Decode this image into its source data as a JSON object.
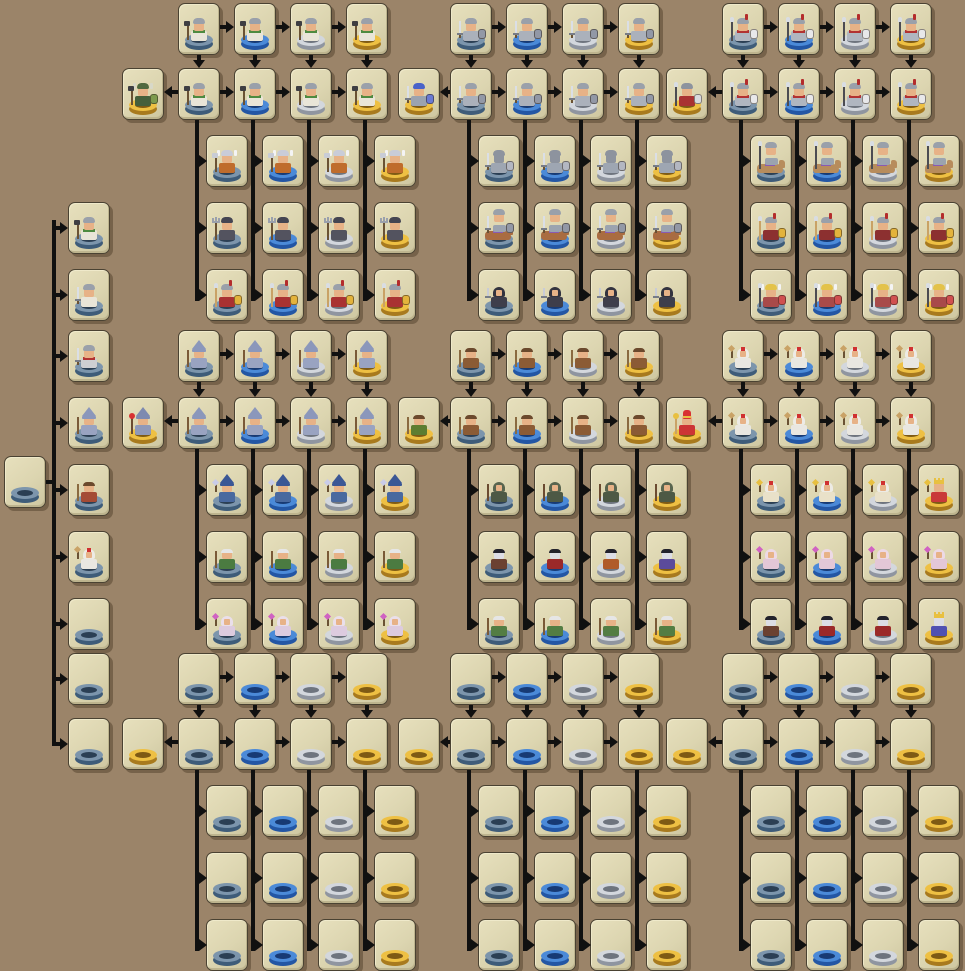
{
  "app": {
    "name": "Unit Evolution Tree",
    "description": "Pixel-art unit upgrade tree with tiered bases"
  },
  "palette": {
    "background": "#9b8469",
    "card_bg": "#dcd5b0",
    "card_border": "#4a4232",
    "arrow": "#101010",
    "skin": "#e7b287",
    "pale_skin": "#dcdde5",
    "wood": "#6a5234",
    "steel": "#777c86",
    "spear_tip": "#d9dde3",
    "tiers": {
      "1": {
        "name": "slate-blue",
        "top": "#7c95ac",
        "side": "#3e5c79",
        "hole": "#2b3f54"
      },
      "2": {
        "name": "bright-blue",
        "top": "#4b8ad8",
        "side": "#2356a4",
        "hole": "#173a74"
      },
      "3": {
        "name": "silver",
        "top": "#d3d7dd",
        "side": "#8f95a0",
        "hole": "#6e747e"
      },
      "4": {
        "name": "gold",
        "top": "#eec043",
        "side": "#a87a1e",
        "hole": "#7e5a14"
      }
    }
  },
  "unit_types": {
    "viking": {
      "hat": [
        "helm",
        "#9aa0aa"
      ],
      "body": "#e9e5d8",
      "collar": "#4e8a40",
      "weapon": [
        "axe",
        "#3e3e42"
      ]
    },
    "militia_sword": {
      "hat": [
        "helm",
        "#9aa0aa"
      ],
      "body": "#e9e5d8",
      "weapon": [
        "sword",
        "#dbdfe6"
      ]
    },
    "soldier": {
      "hat": [
        "helm",
        "#9aa0aa"
      ],
      "body": "#cfcfd2",
      "collar": "#b23232",
      "weapon": [
        "sword",
        "#dbdfe6"
      ]
    },
    "viking_chief": {
      "hat": [
        "horn",
        "#50693f",
        "#d8d8c8"
      ],
      "body": "#455f3b",
      "weapon": [
        "axe",
        "#3e3e42"
      ],
      "shield": "#7d9a4d"
    },
    "winged_viking": {
      "hat": [
        "wing",
        "#c9ccd8",
        "#f4f4f4"
      ],
      "body": "#bf6c2c",
      "weapon": [
        "axe",
        "#c8ccd6"
      ]
    },
    "dark_trident": {
      "hat": [
        "helm",
        "#454552"
      ],
      "body": "#53535f",
      "weapon": [
        "trident",
        "#9aa0ac"
      ]
    },
    "spartan": {
      "hat": [
        "plume",
        "#9aa0aa",
        "#b42c2c"
      ],
      "body": "#a93232",
      "weapon": [
        "spear",
        "#c9a266"
      ],
      "shield": "#e3b33c"
    },
    "swordsman": {
      "hat": [
        "helm",
        "#9aa0aa"
      ],
      "body": "#abb1bb",
      "weapon": [
        "sword",
        "#dbdfe6"
      ],
      "shield": "#9298a6"
    },
    "blue_knight": {
      "hat": [
        "helm",
        "#4a63c9"
      ],
      "body": "#9ba3af",
      "weapon": [
        "sword",
        "#dbdfe6"
      ],
      "shield": "#6a7ad2"
    },
    "plate_knight": {
      "hat": [
        "helm",
        "#8d939e"
      ],
      "skin": "#8d939e",
      "body": "#9ea6b2",
      "weapon": [
        "sword",
        "#dbdfe6"
      ],
      "shield": "#b3b7c2"
    },
    "cavalry": {
      "mount": "#a96c41",
      "saddle": "#8a5ab2",
      "hat": [
        "helm",
        "#9aa0aa"
      ],
      "body": "#9ba3af",
      "weapon": [
        "sword",
        "#dbdfe6"
      ],
      "shield": "#9298a6"
    },
    "rogue": {
      "hat": [
        "hood",
        "#33333f"
      ],
      "body": "#3e3e4b",
      "weapon": [
        "dagger",
        "#c9ccd6"
      ]
    },
    "spearman": {
      "hat": [
        "plume",
        "#9aa0aa",
        "#b42c2c"
      ],
      "body": "#b0b6c0",
      "collar": "#b23232",
      "weapon": [
        "spear",
        "#4c4c52"
      ],
      "shield": "#e8e8ea"
    },
    "spear_champion": {
      "hat": [
        "helm",
        "#8d939e"
      ],
      "body": "#a93232",
      "weapon": [
        "spear",
        "#4c4c52"
      ],
      "shield": "#d9dade"
    },
    "lancer": {
      "mount": "#b78c5c",
      "saddle": "#8a5ab2",
      "hat": [
        "helm",
        "#9aa0aa"
      ],
      "body": "#9ba3af",
      "weapon": [
        "spear",
        "#4c4c52"
      ]
    },
    "hoplite": {
      "hat": [
        "plume",
        "#9aa0aa",
        "#b42c2c"
      ],
      "body": "#8c3030",
      "weapon": [
        "spear",
        "#c9a266"
      ],
      "shield": "#e3b33c"
    },
    "valkyrie": {
      "hat": [
        "wing",
        "#e3c24a",
        "#f4f4f4"
      ],
      "body": "#a84a4a",
      "weapon": [
        "spear",
        "#4c4c52"
      ],
      "shield": "#d05050"
    },
    "wizard": {
      "hat": [
        "point",
        "#8b97bb"
      ],
      "body": "#99a3c1",
      "weapon": [
        "staff",
        "#7a5a38"
      ]
    },
    "archmage": {
      "hat": [
        "point",
        "#7e8ab0"
      ],
      "body": "#8f99b9",
      "weapon": [
        "staff",
        "#6b4b31",
        "#d83232"
      ]
    },
    "witch": {
      "hat": [
        "point",
        "#3b5795"
      ],
      "body": "#49699f",
      "weapon": [
        "wand",
        "#c9cce8"
      ]
    },
    "green_elder": {
      "hat": [
        "hair",
        "#e6e6e6"
      ],
      "body": "#4b7b41",
      "weapon": [
        "staff",
        "#7a5a38"
      ]
    },
    "healer": {
      "hat": [
        "hood",
        "#eadfea"
      ],
      "body": "#ddcbdf",
      "weapon": [
        "wand",
        "#d062c2"
      ]
    },
    "druid": {
      "hat": [
        "hair",
        "#6b492d"
      ],
      "body": "#8b5b35",
      "weapon": [
        "staff",
        "#8a6a40"
      ]
    },
    "grove_keeper": {
      "hat": [
        "hair",
        "#6b492d"
      ],
      "body": "#5d7d31",
      "weapon": [
        "staff",
        "#8a6a40"
      ]
    },
    "ranger": {
      "hat": [
        "hood",
        "#59654f"
      ],
      "body": "#4d5945",
      "weapon": [
        "staff",
        "#6b4b31"
      ]
    },
    "elder_druid": {
      "hat": [
        "hair",
        "#e6e6e6"
      ],
      "body": "#537d43",
      "weapon": [
        "staff",
        "#7a5a38"
      ]
    },
    "cleric": {
      "hat": [
        "hood",
        "#edebe5",
        "#d03030"
      ],
      "body": "#e9e7e1",
      "weapon": [
        "wand",
        "#c9a266"
      ]
    },
    "pope": {
      "hat": [
        "mitre",
        "#d83232",
        "#e8c040"
      ],
      "body": "#cc3535",
      "weapon": [
        "staff",
        "#c9a266",
        "#e8c040"
      ]
    },
    "high_priest": {
      "hat": [
        "hood",
        "#edebe5",
        "#d03030"
      ],
      "body": "#e9e1c9",
      "weapon": [
        "wand",
        "#e8c040"
      ]
    },
    "priest_king": {
      "hat": [
        "crown",
        "#e8c040"
      ],
      "body": "#c93939",
      "weapon": [
        "wand",
        "#e8c040"
      ]
    },
    "nun": {
      "hat": [
        "hood",
        "#edd9e5"
      ],
      "body": "#e3c7d7",
      "weapon": [
        "wand",
        "#d062c2"
      ]
    },
    "vamp_brown": {
      "hat": [
        "hair",
        "#22222c"
      ],
      "skin": "#dcdde5",
      "body": "#6b4131"
    },
    "vamp_red": {
      "hat": [
        "hair",
        "#22222c"
      ],
      "skin": "#dcdde5",
      "body": "#9b2929"
    },
    "vamp_orange": {
      "hat": [
        "hair",
        "#22222c"
      ],
      "skin": "#dcdde5",
      "body": "#b05b29"
    },
    "vamp_purple": {
      "hat": [
        "hair",
        "#22222c"
      ],
      "skin": "#dcdde5",
      "body": "#5b4b9b"
    },
    "vamp_royal": {
      "hat": [
        "crown",
        "#e8c040"
      ],
      "skin": "#dcdde5",
      "body": "#5051b1"
    },
    "peasant": {
      "hat": [
        "hair",
        "#6b492d"
      ],
      "body": "#a44b35",
      "weapon": [
        "staff",
        "#8a6a40"
      ]
    }
  },
  "layout": {
    "canvas": {
      "w": 965,
      "h": 969
    },
    "card": {
      "w": 42,
      "h": 52
    },
    "root": {
      "x": 4,
      "y": 456,
      "tier": 1,
      "unit": null
    },
    "left_column": {
      "x": 68,
      "spine_x": 52,
      "spine_top": 220,
      "spine_bottom": 746,
      "tier": 1,
      "cards": [
        {
          "y": 202,
          "unit": "viking"
        },
        {
          "y": 269,
          "unit": "militia_sword"
        },
        {
          "y": 330,
          "unit": "soldier"
        },
        {
          "y": 397,
          "unit": "wizard"
        },
        {
          "y": 464,
          "unit": "peasant"
        },
        {
          "y": 531,
          "unit": "cleric"
        },
        {
          "y": 598,
          "unit": null
        },
        {
          "y": 653,
          "unit": null
        },
        {
          "y": 718,
          "unit": null
        }
      ]
    },
    "bands": [
      {
        "rows": [
          3,
          68,
          135,
          202,
          269
        ],
        "clusters": [
          {
            "cols": [
              178,
              234,
              290,
              346
            ],
            "gold_x": 122,
            "subs": [
              206,
              262,
              318,
              374
            ],
            "units": {
              "A": "viking",
              "B": "viking",
              "gold": "viking_chief",
              "C": "winged_viking",
              "D": "dark_trident",
              "E": "spartan"
            }
          },
          {
            "cols": [
              450,
              506,
              562,
              618
            ],
            "gold_x": 398,
            "subs": [
              478,
              534,
              590,
              646
            ],
            "units": {
              "A": "swordsman",
              "B": "swordsman",
              "gold": "blue_knight",
              "C": "plate_knight",
              "D": "cavalry",
              "E": "rogue"
            }
          },
          {
            "cols": [
              722,
              778,
              834,
              890
            ],
            "gold_x": 666,
            "subs": [
              750,
              806,
              862,
              918
            ],
            "units": {
              "A": "spearman",
              "B": "spearman",
              "gold": "spear_champion",
              "C": "lancer",
              "D": "hoplite",
              "E": "valkyrie"
            }
          }
        ]
      },
      {
        "rows": [
          330,
          397,
          464,
          531,
          598
        ],
        "clusters": [
          {
            "cols": [
              178,
              234,
              290,
              346
            ],
            "gold_x": 122,
            "subs": [
              206,
              262,
              318,
              374
            ],
            "units": {
              "A": "wizard",
              "B": "wizard",
              "gold": "archmage",
              "C": "witch",
              "D": "green_elder",
              "E": "healer"
            }
          },
          {
            "cols": [
              450,
              506,
              562,
              618
            ],
            "gold_x": 398,
            "subs": [
              478,
              534,
              590,
              646
            ],
            "units": {
              "A": "druid",
              "B": "druid",
              "gold": "grove_keeper",
              "C": "ranger",
              "D": [
                "vamp_brown",
                "vamp_red",
                "vamp_orange",
                "vamp_purple"
              ],
              "E": "elder_druid"
            }
          },
          {
            "cols": [
              722,
              778,
              834,
              890
            ],
            "gold_x": 666,
            "subs": [
              750,
              806,
              862,
              918
            ],
            "units": {
              "A": "cleric",
              "B": "cleric",
              "gold": "pope",
              "C": [
                "high_priest",
                "high_priest",
                "high_priest",
                "priest_king"
              ],
              "D": "nun",
              "E": [
                "vamp_brown",
                "vamp_red",
                "vamp_red",
                "vamp_royal"
              ]
            }
          }
        ]
      },
      {
        "rows": [
          653,
          718,
          785,
          852,
          919
        ],
        "clusters": [
          {
            "cols": [
              178,
              234,
              290,
              346
            ],
            "gold_x": 122,
            "subs": [
              206,
              262,
              318,
              374
            ],
            "units": {
              "A": null,
              "B": null,
              "gold": null,
              "C": null,
              "D": null,
              "E": null
            }
          },
          {
            "cols": [
              450,
              506,
              562,
              618
            ],
            "gold_x": 398,
            "subs": [
              478,
              534,
              590,
              646
            ],
            "units": {
              "A": null,
              "B": null,
              "gold": null,
              "C": null,
              "D": null,
              "E": null
            }
          },
          {
            "cols": [
              722,
              778,
              834,
              890
            ],
            "gold_x": 666,
            "subs": [
              750,
              806,
              862,
              918
            ],
            "units": {
              "A": null,
              "B": null,
              "gold": null,
              "C": null,
              "D": null,
              "E": null
            }
          }
        ]
      }
    ]
  }
}
